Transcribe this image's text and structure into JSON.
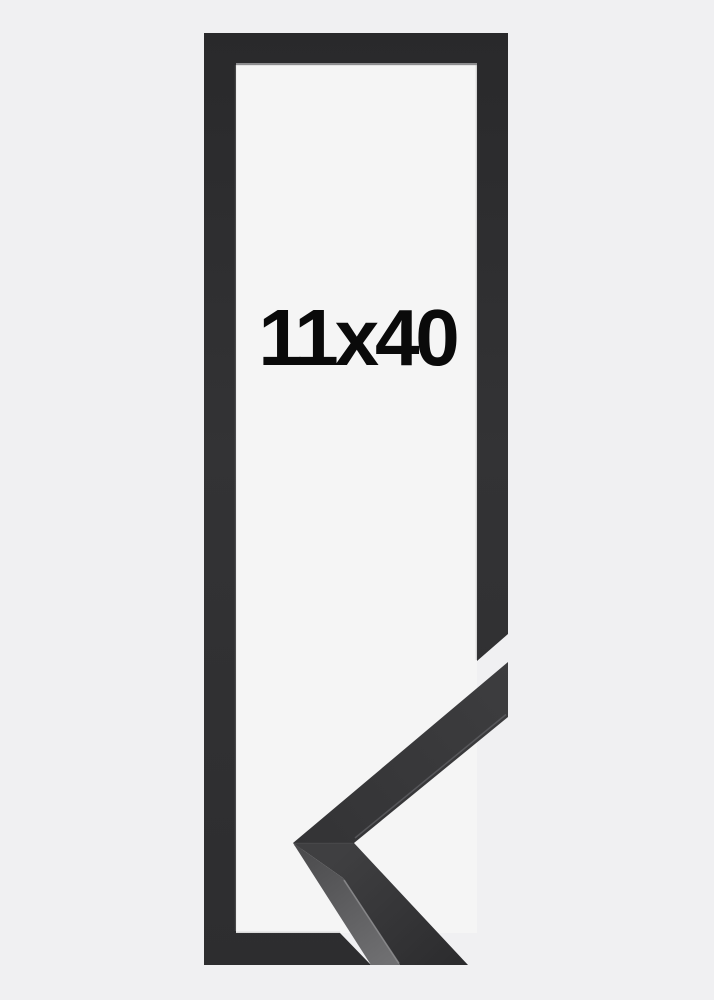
{
  "frame_preview": {
    "size_label": "11x40",
    "colors": {
      "background": "#f0f0f2",
      "opening": "#f5f5f5",
      "moulding": "#2e2e30",
      "side_face": "#5f5f61",
      "lip_highlight": "#98989a",
      "label": "#0a0a0a"
    }
  }
}
